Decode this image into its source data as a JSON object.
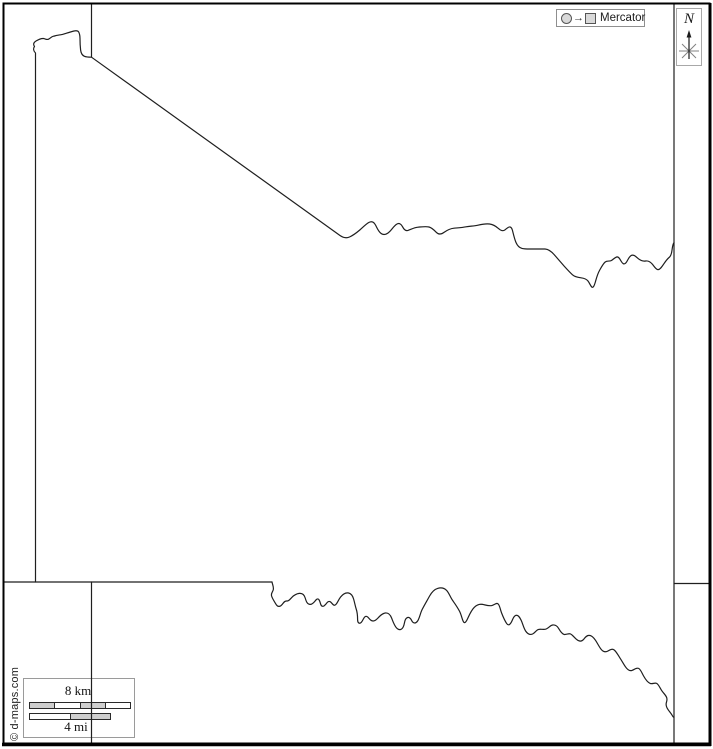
{
  "map": {
    "kind": "blank-outline-county-map",
    "projection": {
      "label": "Mercator"
    },
    "compass": {
      "north_label": "N"
    },
    "scale_bar": {
      "km_label": "8 km",
      "mi_label": "4 mi"
    },
    "credit": "© d-maps.com",
    "colors": {
      "background": "#ffffff",
      "map_line": "#1f1f1f",
      "frame": "#000000",
      "legend_border": "#8f8f8f",
      "scale_segment_gray": "#cfcfcf",
      "scale_segment_white": "#ffffff"
    }
  }
}
